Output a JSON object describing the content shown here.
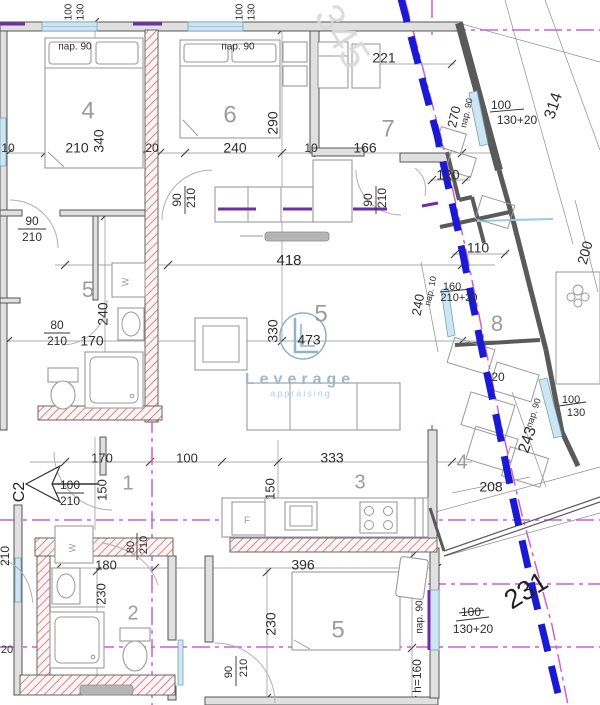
{
  "meta": {
    "drawing_type": "apartment floor plan"
  },
  "colors": {
    "boundary_blue": "#1a1ad4",
    "axis_magenta": "#cf5fcf",
    "wall_gray": "#555555",
    "hatch_pink": "#cf6b78",
    "window_blue": "#cfe6f2",
    "threshold_purple": "#6f2da8",
    "dim_text": "#2e2e2e",
    "room_text": "#9c9c9c"
  },
  "watermark": {
    "brand": "Leverage",
    "tagline": "appraising",
    "logo_letter": "L",
    "ghost_number": "345"
  },
  "entrance_label": "C2",
  "labels": [
    {
      "t": "100",
      "x": 69,
      "y": 12,
      "r": -90,
      "s": 10
    },
    {
      "t": "130",
      "x": 81,
      "y": 12,
      "r": -90,
      "s": 10
    },
    {
      "t": "100",
      "x": 240,
      "y": 12,
      "r": -90,
      "s": 10
    },
    {
      "t": "130",
      "x": 252,
      "y": 12,
      "r": -90,
      "s": 10
    },
    {
      "t": "пар. 90",
      "x": 75,
      "y": 47,
      "s": 10
    },
    {
      "t": "пар. 90",
      "x": 238,
      "y": 47,
      "s": 10
    },
    {
      "t": "4",
      "x": 88,
      "y": 112,
      "s": 24,
      "c": "room"
    },
    {
      "t": "6",
      "x": 230,
      "y": 116,
      "s": 24,
      "c": "room"
    },
    {
      "t": "7",
      "x": 388,
      "y": 130,
      "s": 24,
      "c": "room"
    },
    {
      "t": "210",
      "x": 77,
      "y": 149,
      "s": 14
    },
    {
      "t": "340",
      "x": 100,
      "y": 141,
      "r": -90,
      "s": 14
    },
    {
      "t": "10",
      "x": 8,
      "y": 149,
      "s": 12
    },
    {
      "t": "20",
      "x": 152,
      "y": 149,
      "s": 12
    },
    {
      "t": "240",
      "x": 235,
      "y": 149,
      "s": 14
    },
    {
      "t": "10",
      "x": 311,
      "y": 149,
      "s": 12
    },
    {
      "t": "166",
      "x": 365,
      "y": 149,
      "s": 14
    },
    {
      "t": "290",
      "x": 274,
      "y": 123,
      "r": -90,
      "s": 14
    },
    {
      "t": "221",
      "x": 384,
      "y": 59,
      "s": 14
    },
    {
      "t": "90",
      "x": 32,
      "y": 222,
      "s": 12
    },
    {
      "t": "210",
      "x": 32,
      "y": 238,
      "s": 12
    },
    {
      "t": "90",
      "x": 178,
      "y": 200,
      "r": -90,
      "s": 12
    },
    {
      "t": "210",
      "x": 192,
      "y": 198,
      "r": -90,
      "s": 12
    },
    {
      "t": "90",
      "x": 369,
      "y": 200,
      "r": -90,
      "s": 12
    },
    {
      "t": "210",
      "x": 383,
      "y": 198,
      "r": -90,
      "s": 12
    },
    {
      "t": "270",
      "x": 455,
      "y": 117,
      "r": -77,
      "s": 13
    },
    {
      "t": "пар. 90",
      "x": 467,
      "y": 113,
      "r": -77,
      "s": 9
    },
    {
      "t": "100",
      "x": 501,
      "y": 106,
      "s": 12
    },
    {
      "t": "130+20",
      "x": 517,
      "y": 121,
      "s": 12
    },
    {
      "t": "314",
      "x": 554,
      "y": 106,
      "r": -72,
      "s": 16
    },
    {
      "t": "120",
      "x": 448,
      "y": 176,
      "s": 14
    },
    {
      "t": "110",
      "x": 478,
      "y": 249,
      "s": 14
    },
    {
      "t": "200",
      "x": 586,
      "y": 253,
      "r": -74,
      "s": 14
    },
    {
      "t": "160",
      "x": 452,
      "y": 287,
      "s": 11
    },
    {
      "t": "210+20",
      "x": 459,
      "y": 298,
      "s": 11
    },
    {
      "t": "пар. 10",
      "x": 431,
      "y": 291,
      "r": -78,
      "s": 9
    },
    {
      "t": "240",
      "x": 419,
      "y": 305,
      "r": -80,
      "s": 13
    },
    {
      "t": "8",
      "x": 497,
      "y": 325,
      "s": 22,
      "c": "room"
    },
    {
      "t": "418",
      "x": 289,
      "y": 261,
      "s": 15
    },
    {
      "t": "5",
      "x": 321,
      "y": 315,
      "s": 24,
      "c": "room"
    },
    {
      "t": "330",
      "x": 274,
      "y": 331,
      "r": -90,
      "s": 14
    },
    {
      "t": "473",
      "x": 309,
      "y": 341,
      "s": 14
    },
    {
      "t": "5",
      "x": 88,
      "y": 291,
      "s": 22,
      "c": "room"
    },
    {
      "t": "W",
      "x": 126,
      "y": 282,
      "r": -90,
      "s": 9,
      "c": "room"
    },
    {
      "t": "80",
      "x": 57,
      "y": 326,
      "s": 12
    },
    {
      "t": "210",
      "x": 57,
      "y": 342,
      "s": 12
    },
    {
      "t": "170",
      "x": 92,
      "y": 342,
      "s": 14
    },
    {
      "t": "240",
      "x": 104,
      "y": 314,
      "r": -90,
      "s": 14
    },
    {
      "t": "20",
      "x": 498,
      "y": 378,
      "s": 12
    },
    {
      "t": "пар. 90",
      "x": 534,
      "y": 413,
      "r": -72,
      "s": 9
    },
    {
      "t": "243",
      "x": 528,
      "y": 440,
      "r": -72,
      "s": 16
    },
    {
      "t": "100",
      "x": 571,
      "y": 400,
      "s": 11
    },
    {
      "t": "130",
      "x": 576,
      "y": 413,
      "s": 11
    },
    {
      "t": "4",
      "x": 462,
      "y": 463,
      "s": 20,
      "c": "room"
    },
    {
      "t": "208",
      "x": 491,
      "y": 488,
      "s": 14
    },
    {
      "t": "C2",
      "x": 20,
      "y": 492,
      "r": -90,
      "s": 16,
      "c": "strong"
    },
    {
      "t": "100",
      "x": 70,
      "y": 486,
      "s": 12
    },
    {
      "t": "210",
      "x": 70,
      "y": 502,
      "s": 12
    },
    {
      "t": "170",
      "x": 102,
      "y": 459,
      "s": 13
    },
    {
      "t": "150",
      "x": 103,
      "y": 490,
      "r": -90,
      "s": 13
    },
    {
      "t": "1",
      "x": 128,
      "y": 484,
      "s": 20,
      "c": "room"
    },
    {
      "t": "100",
      "x": 187,
      "y": 459,
      "s": 13
    },
    {
      "t": "333",
      "x": 332,
      "y": 459,
      "s": 14
    },
    {
      "t": "3",
      "x": 360,
      "y": 483,
      "s": 20,
      "c": "room"
    },
    {
      "t": "150",
      "x": 271,
      "y": 489,
      "r": -90,
      "s": 13
    },
    {
      "t": "F",
      "x": 247,
      "y": 521,
      "s": 10,
      "c": "room"
    },
    {
      "t": "W",
      "x": 73,
      "y": 548,
      "r": -90,
      "s": 9,
      "c": "room"
    },
    {
      "t": "80",
      "x": 131,
      "y": 547,
      "r": -90,
      "s": 11
    },
    {
      "t": "210",
      "x": 144,
      "y": 545,
      "r": -90,
      "s": 11
    },
    {
      "t": "180",
      "x": 106,
      "y": 566,
      "s": 13
    },
    {
      "t": "230",
      "x": 102,
      "y": 594,
      "r": -90,
      "s": 13
    },
    {
      "t": "2",
      "x": 133,
      "y": 614,
      "s": 20,
      "c": "room"
    },
    {
      "t": "90",
      "x": 229,
      "y": 672,
      "r": -90,
      "s": 11
    },
    {
      "t": "210",
      "x": 244,
      "y": 668,
      "r": -90,
      "s": 11
    },
    {
      "t": "396",
      "x": 303,
      "y": 566,
      "s": 14
    },
    {
      "t": "230",
      "x": 272,
      "y": 624,
      "r": -90,
      "s": 14
    },
    {
      "t": "5",
      "x": 338,
      "y": 631,
      "s": 24,
      "c": "room"
    },
    {
      "t": "пар. 90",
      "x": 420,
      "y": 617,
      "r": -90,
      "s": 10
    },
    {
      "t": "h=160",
      "x": 418,
      "y": 676,
      "r": -90,
      "s": 12
    },
    {
      "t": "100",
      "x": 471,
      "y": 613,
      "s": 12
    },
    {
      "t": "130+20",
      "x": 473,
      "y": 630,
      "s": 12
    },
    {
      "t": "231",
      "x": 527,
      "y": 592,
      "r": -32,
      "s": 27,
      "c": "strong"
    },
    {
      "t": "345",
      "x": 340,
      "y": 38,
      "r": 58,
      "s": 40,
      "c": "ghost"
    },
    {
      "t": "210",
      "x": 6,
      "y": 556,
      "r": -90,
      "s": 12
    },
    {
      "t": "20",
      "x": 7,
      "y": 650,
      "s": 11
    },
    {
      "t": "Leverage",
      "x": 300,
      "y": 380,
      "s": 16,
      "c": "brand"
    },
    {
      "t": "appraising",
      "x": 301,
      "y": 394,
      "s": 9,
      "c": "brandlight"
    }
  ]
}
